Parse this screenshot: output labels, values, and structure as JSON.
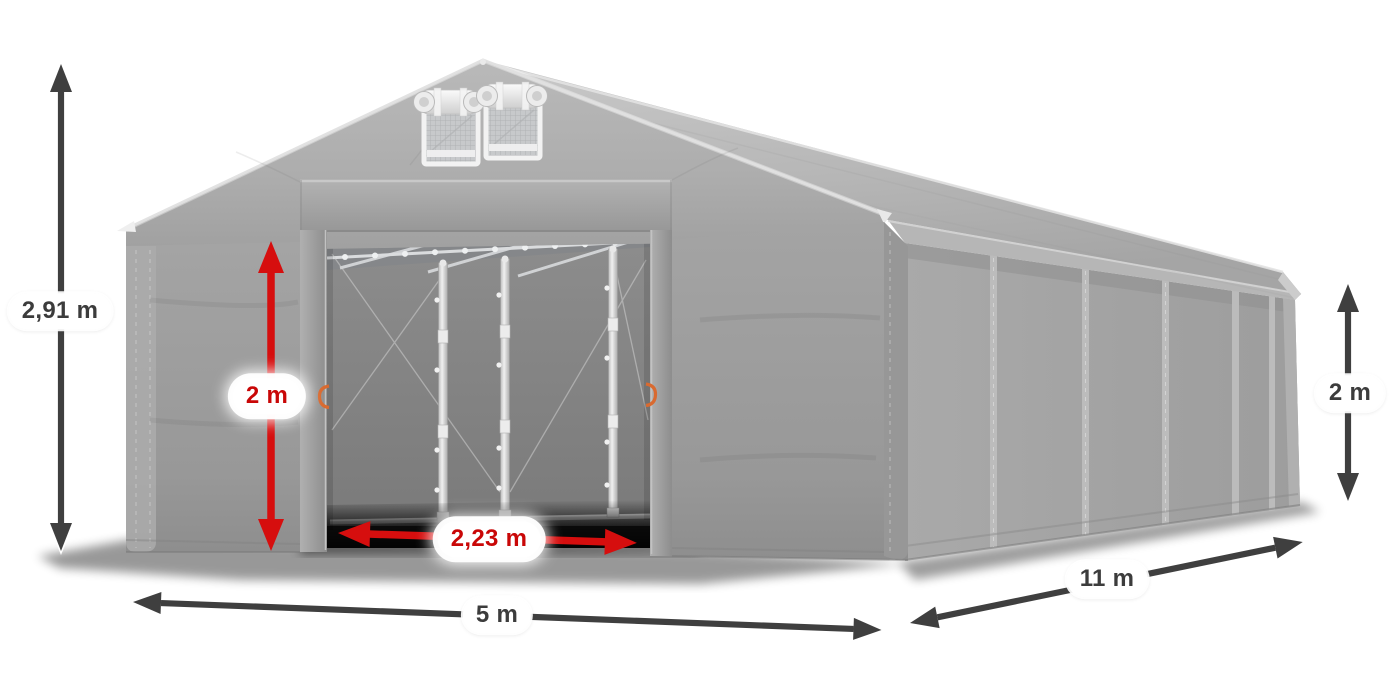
{
  "meta": {
    "background": "#ffffff",
    "subject": "Gray storage tent / marquee product illustration annotated with dimension arrows"
  },
  "dims": {
    "total_height": "2,91 m",
    "front_width": "5 m",
    "side_length": "11 m",
    "side_height": "2 m",
    "entrance_height": "2 m",
    "entrance_width": "2,23 m"
  },
  "colors": {
    "tent_gray": "#a6a6a6",
    "tent_gray_dark": "#8f8f8f",
    "interior_gray": "#7e7e7e",
    "frame_silver": "#d9d9d9",
    "door_handle_orange": "#d96a30",
    "dimension_arrow_dark": "#3f3f3f",
    "dimension_arrow_red": "#d60e0e",
    "label_background": "#ffffff",
    "label_text_dark": "#3c3c3c",
    "label_text_red": "#c90707"
  }
}
